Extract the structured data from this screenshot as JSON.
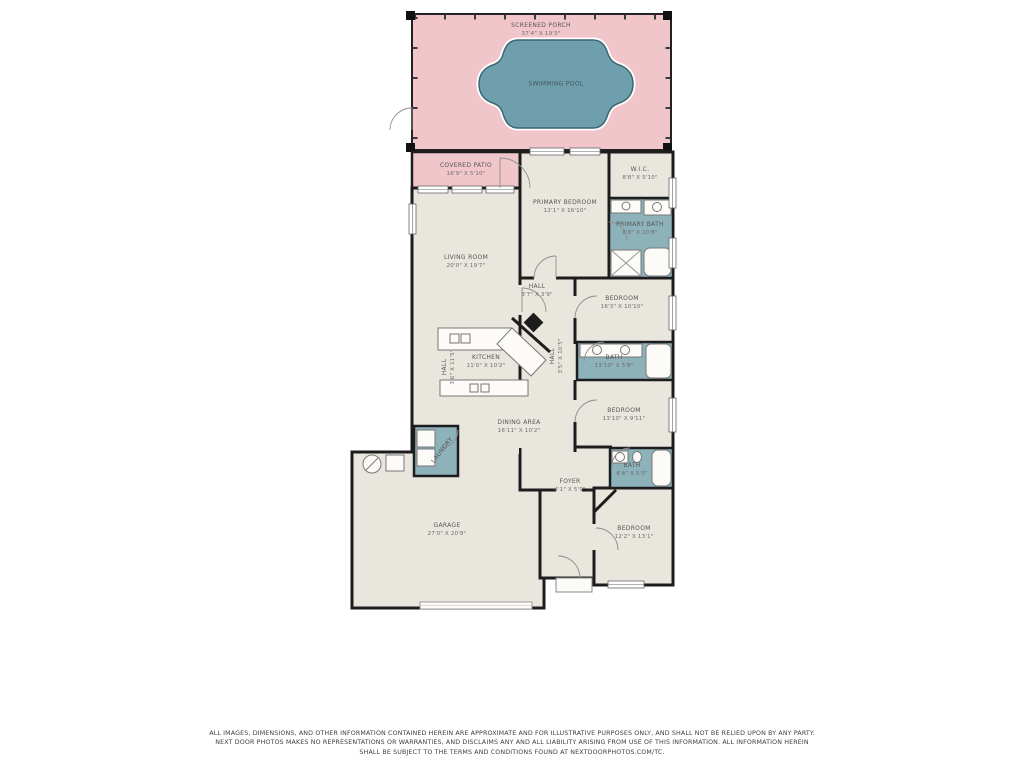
{
  "rooms": {
    "screened_porch": {
      "name": "SCREENED PORCH",
      "dims": "37'4\" X 19'3\""
    },
    "swimming_pool": {
      "name": "SWIMMING POOL"
    },
    "covered_patio": {
      "name": "COVERED PATIO",
      "dims": "16'9\" X 5'10\""
    },
    "primary_bedroom": {
      "name": "PRIMARY BEDROOM",
      "dims": "12'1\" X 16'10\""
    },
    "wic": {
      "name": "W.I.C.",
      "dims": "8'8\" X 5'10\""
    },
    "primary_bath": {
      "name": "PRIMARY BATH",
      "dims": "8'8\" X 10'8\""
    },
    "living_room": {
      "name": "LIVING ROOM",
      "dims": "20'0\" X 19'7\""
    },
    "hall_small": {
      "name": "HALL",
      "dims": "3'7\" X 3'9\""
    },
    "bedroom_mid": {
      "name": "BEDROOM",
      "dims": "16'3\" X 10'10\""
    },
    "bath_mid": {
      "name": "BATH",
      "dims": "13'10\" X 5'8\""
    },
    "kitchen": {
      "name": "KITCHEN",
      "dims": "11'0\" X 10'2\""
    },
    "hall_left": {
      "name": "HALL",
      "dims": "3'6\" X 11'5\""
    },
    "hall_right": {
      "name": "HALL",
      "dims": "3'5\" X 10'5\""
    },
    "dining_area": {
      "name": "DINING AREA",
      "dims": "16'11\" X 10'2\""
    },
    "laundry": {
      "name": "LAUNDRY"
    },
    "bedroom_right": {
      "name": "BEDROOM",
      "dims": "13'10\" X 9'11\""
    },
    "bath_small": {
      "name": "BATH",
      "dims": "8'4\" X 5'3\""
    },
    "garage": {
      "name": "GARAGE",
      "dims": "27'0\" X 20'8\""
    },
    "foyer": {
      "name": "FOYER",
      "dims": "4'1\" X 5'9\""
    },
    "bedroom_bottom": {
      "name": "BEDROOM",
      "dims": "12'2\" X 13'1\""
    }
  },
  "disclaimer": {
    "line1": "ALL IMAGES, DIMENSIONS, AND OTHER INFORMATION CONTAINED HEREIN ARE APPROXIMATE AND FOR ILLUSTRATIVE PURPOSES ONLY, AND SHALL NOT BE RELIED UPON BY ANY PARTY.",
    "line2": "NEXT DOOR PHOTOS MAKES NO REPRESENTATIONS OR WARRANTIES, AND DISCLAIMS ANY AND ALL LIABILITY ARISING FROM USE OF THIS INFORMATION. ALL INFORMATION HEREIN",
    "line3": "SHALL BE SUBJECT TO THE TERMS AND CONDITIONS FOUND AT NEXTDOORPHOTOS.COM/TC."
  },
  "colors": {
    "porch_pink": "#f1c6cb",
    "floor_beige": "#e9e6de",
    "bath_teal": "#8db2ba",
    "pool_teal": "#6f9fad",
    "wall": "#1d1d1d"
  }
}
